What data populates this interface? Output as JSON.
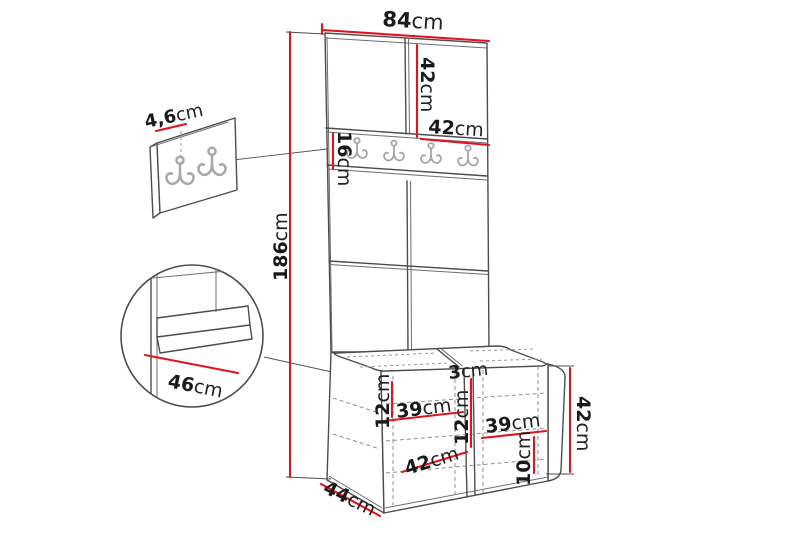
{
  "diagram": {
    "type": "furniture-dimension-diagram",
    "subject": "hallway wardrobe unit with coat hooks and shoe bench",
    "colors": {
      "dimension_red": "#e2131e",
      "outline": "#4d4d4d",
      "hook_gray": "#a9a9a9",
      "background": "#ffffff"
    },
    "icons": [
      "double-coat-hook-icon"
    ],
    "dimensions": {
      "total_width": {
        "value": "84",
        "unit": "cm"
      },
      "top_door_height": {
        "value": "42",
        "unit": "cm"
      },
      "top_door_width": {
        "value": "42",
        "unit": "cm"
      },
      "hook_rail_height": {
        "value": "16",
        "unit": "cm"
      },
      "total_height": {
        "value": "186",
        "unit": "cm"
      },
      "panel_depth": {
        "value": "4,6",
        "unit": "cm"
      },
      "seat_depth": {
        "value": "46",
        "unit": "cm"
      },
      "divider_thickness": {
        "value": "3",
        "unit": "cm"
      },
      "left_shelf_height": {
        "value": "12",
        "unit": "cm"
      },
      "left_compartment_width": {
        "value": "39",
        "unit": "cm"
      },
      "right_shelf_height": {
        "value": "12",
        "unit": "cm"
      },
      "right_compartment_width": {
        "value": "39",
        "unit": "cm"
      },
      "bottom_shelf_height": {
        "value": "10",
        "unit": "cm"
      },
      "bench_door_width": {
        "value": "42",
        "unit": "cm"
      },
      "bench_height": {
        "value": "42",
        "unit": "cm"
      },
      "bench_depth": {
        "value": "44",
        "unit": "cm"
      }
    }
  }
}
